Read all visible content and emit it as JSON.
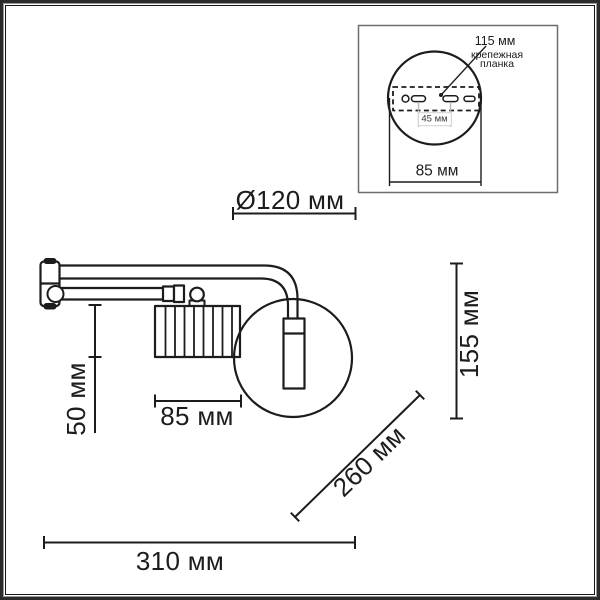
{
  "dimensions": {
    "diameter": "Ø120 мм",
    "height": "155 мм",
    "shade_height": "50 мм",
    "shade_width": "85 мм",
    "arm_length": "260 мм",
    "total_length": "310 мм"
  },
  "inset": {
    "plate_length": "115 мм",
    "plate_label_line1": "крепежная",
    "plate_label_line2": "планка",
    "slot_spacing": "45 мм",
    "plate_width": "85 мм"
  },
  "colors": {
    "line": "#1c1c1c",
    "gray_dim": "#b8b8b8",
    "frame": "#2b2b2b"
  }
}
